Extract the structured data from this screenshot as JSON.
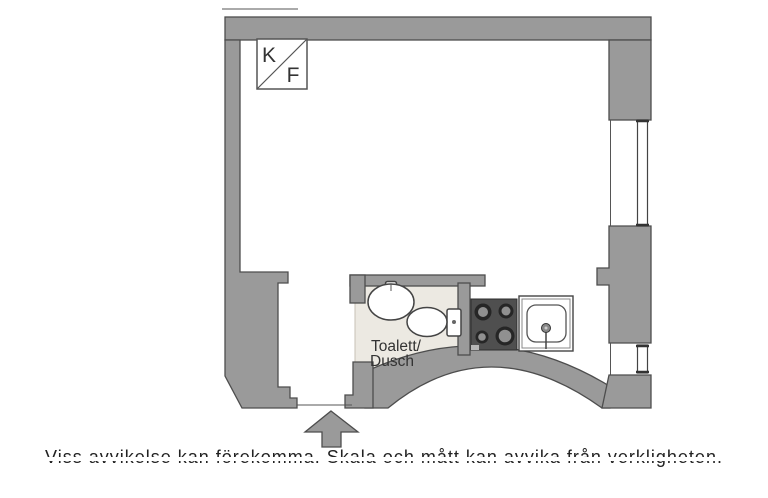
{
  "floor_plan": {
    "labels": {
      "fridge_freezer_top": "K",
      "fridge_freezer_bottom": "F",
      "bathroom_line1": "Toalett/",
      "bathroom_line2": "Dusch"
    },
    "disclaimer": "Viss avvikelse kan förekomma. Skala och mått kan avvika från verkligheten.",
    "icons": {
      "entrance_arrow": "up-arrow",
      "fridge_freezer_symbol": "square-with-diagonal",
      "fixtures": [
        "washbasin",
        "toilet",
        "stove-4-burners",
        "kitchen-sink",
        "window",
        "window"
      ]
    },
    "colors": {
      "wall_fill": "#9a9a9a",
      "wall_outline": "#4d4d4d",
      "bathroom_floor": "#ece9e2",
      "stove_body": "#4f4f4f",
      "burner_ring": "#262626",
      "burner_center": "#909090",
      "fixture_outline": "#444444",
      "text": "#333333"
    }
  }
}
